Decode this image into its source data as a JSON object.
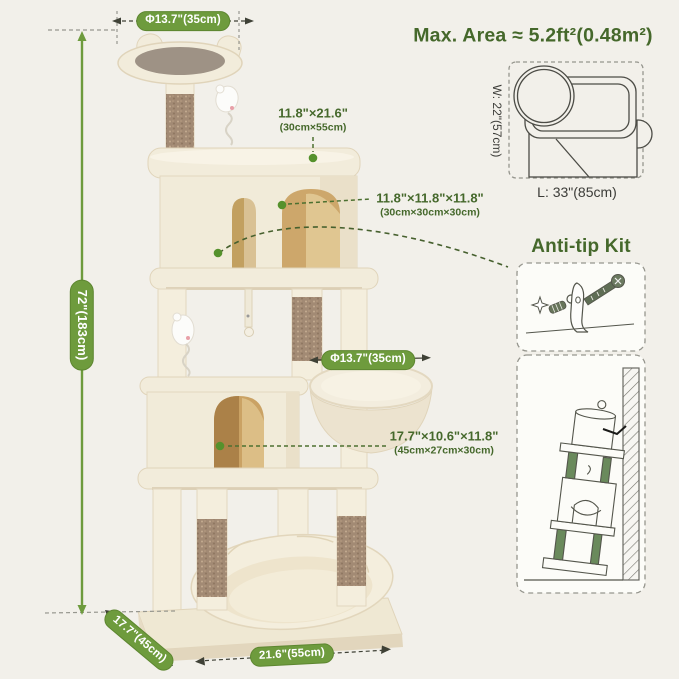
{
  "colors": {
    "accent_green": "#6e9b3d",
    "text_green": "#45682b",
    "leader_green": "#4c7030",
    "dot_green": "#55912c",
    "background": "#f2f0ea"
  },
  "header": {
    "max_area": "Max. Area ≈ 5.2ft²(0.48m²)"
  },
  "dims": {
    "top_perch_diameter": "Φ13.7\"(35cm)",
    "height": "72\"(183cm)",
    "top_platform_in": "11.8\"×21.6\"",
    "top_platform_cm": "(30cm×55cm)",
    "upper_condo_in": "11.8\"×11.8\"×11.8\"",
    "upper_condo_cm": "(30cm×30cm×30cm)",
    "hammock_diameter": "Φ13.7\"(35cm)",
    "lower_condo_in": "17.7\"×10.6\"×11.8\"",
    "lower_condo_cm": "(45cm×27cm×30cm)",
    "base_depth": "17.7\"(45cm)",
    "base_width": "21.6\"(55cm)"
  },
  "footprint": {
    "width_label": "W: 22\"(57cm)",
    "length_label": "L: 33\"(85cm)"
  },
  "antitip": {
    "title": "Anti-tip Kit"
  }
}
